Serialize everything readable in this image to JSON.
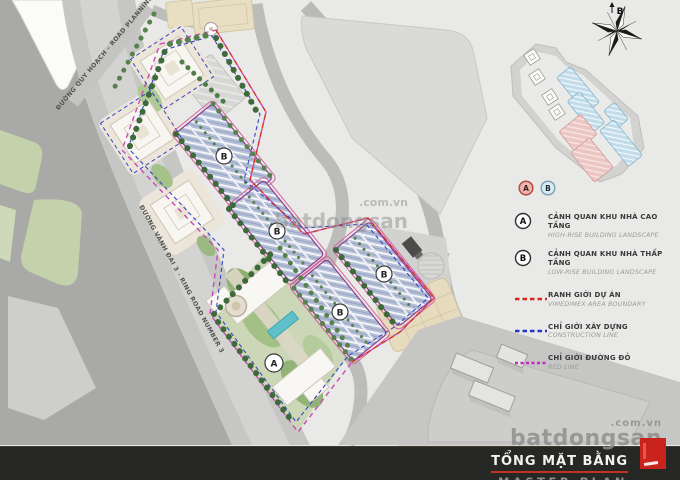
{
  "map": {
    "zone_labels": {
      "high_rise": "A",
      "low_rise": "B"
    },
    "roads": [
      {
        "vn": "ĐƯỜNG QUY HOẠCH",
        "en": "ROAD PLANNING",
        "label": "ĐƯỜNG QUY HOẠCH - ROAD PLANNING"
      },
      {
        "vn": "ĐƯỜNG VÀNH ĐAI 3",
        "en": "RING ROAD NUMBER 3",
        "label": "ĐƯỜNG VÀNH ĐAI 3 - RING ROAD NUMBER 3"
      }
    ],
    "compass": {
      "north": "B"
    }
  },
  "legend": {
    "swatch_a": {
      "label": "A",
      "fill": "#efb4ad",
      "border": "#b84a3e"
    },
    "swatch_b": {
      "label": "B",
      "fill": "#dcebf2",
      "border": "#7aa4b8"
    },
    "items": [
      {
        "key": "A",
        "vn": "CẢNH QUAN KHU NHÀ CAO TẦNG",
        "en": "HIGH-RISE BUILDING LANDSCAPE"
      },
      {
        "key": "B",
        "vn": "CẢNH QUAN KHU NHÀ THẤP TẦNG",
        "en": "LOW-RISE BUILDING LANDSCAPE"
      },
      {
        "color": "#d2281e",
        "vn": "RANH GIỚI DỰ ÁN",
        "en": "VIMEDIMEX AREA BOUNDARY"
      },
      {
        "color": "#2834c6",
        "vn": "CHỈ GIỚI XÂY DỰNG",
        "en": "CONSTRUCTION LINE"
      },
      {
        "color": "#c32bc0",
        "vn": "CHỈ GIỚI ĐƯỜNG ĐỎ",
        "en": "RED LINE"
      }
    ]
  },
  "footer": {
    "title_vn": "TỔNG MẶT BẰNG",
    "title_en": "MASTER PLAN"
  },
  "watermark": {
    "brand": "batdongsan",
    "suffix": ".com.vn"
  }
}
